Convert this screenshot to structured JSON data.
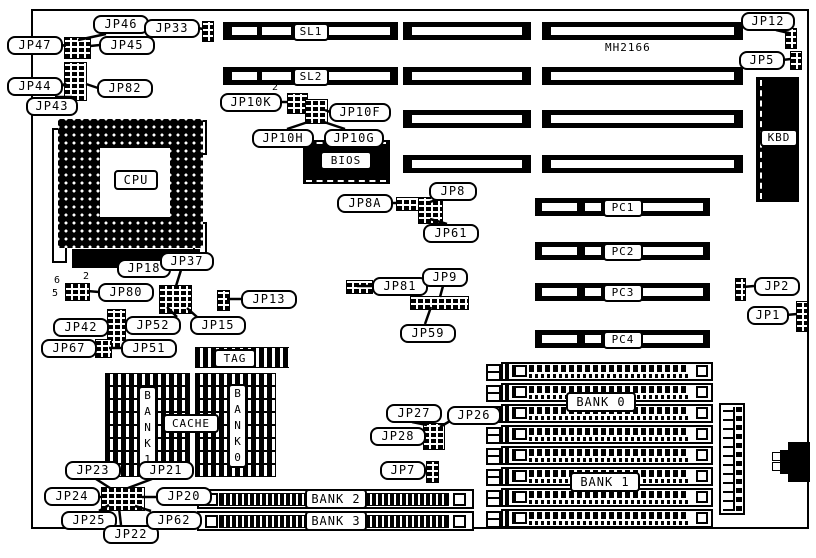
{
  "part_number": "MH2166",
  "jumpers": {
    "jp46": "JP46",
    "jp47": "JP47",
    "jp45": "JP45",
    "jp44": "JP44",
    "jp82": "JP82",
    "jp43": "JP43",
    "jp33": "JP33",
    "jp12": "JP12",
    "jp5": "JP5",
    "jp10k": "JP10K",
    "jp10f": "JP10F",
    "jp10h": "JP10H",
    "jp10g": "JP10G",
    "jp8a": "JP8A",
    "jp8": "JP8",
    "jp61": "JP61",
    "jp81": "JP81",
    "jp9": "JP9",
    "jp59": "JP59",
    "jp13": "JP13",
    "jp18": "JP18",
    "jp37": "JP37",
    "jp80": "JP80",
    "jp52": "JP52",
    "jp15": "JP15",
    "jp42": "JP42",
    "jp67": "JP67",
    "jp51": "JP51",
    "jp23": "JP23",
    "jp21": "JP21",
    "jp24": "JP24",
    "jp20": "JP20",
    "jp25": "JP25",
    "jp22": "JP22",
    "jp62": "JP62",
    "jp27": "JP27",
    "jp26": "JP26",
    "jp28": "JP28",
    "jp7": "JP7",
    "jp2": "JP2",
    "jp1": "JP1"
  },
  "slots": {
    "sl1": "SL1",
    "sl2": "SL2",
    "pc1": "PC1",
    "pc2": "PC2",
    "pc3": "PC3",
    "pc4": "PC4",
    "bank0": "BANK 0",
    "bank1": "BANK 1",
    "bank2": "BANK 2",
    "bank3": "BANK 3"
  },
  "chips": {
    "cpu": "CPU",
    "bios": "BIOS",
    "kbd": "KBD",
    "tag": "TAG",
    "cache": "CACHE",
    "cache_bank1": "B\nA\nN\nK\n1",
    "cache_bank0": "B\nA\nN\nK\n0"
  },
  "pin_numbers": {
    "jp10k_pin2": "2",
    "jp10k_pin4": "4",
    "jp80_pin6": "6",
    "jp80_pin2": "2",
    "jp80_pin5": "5"
  }
}
